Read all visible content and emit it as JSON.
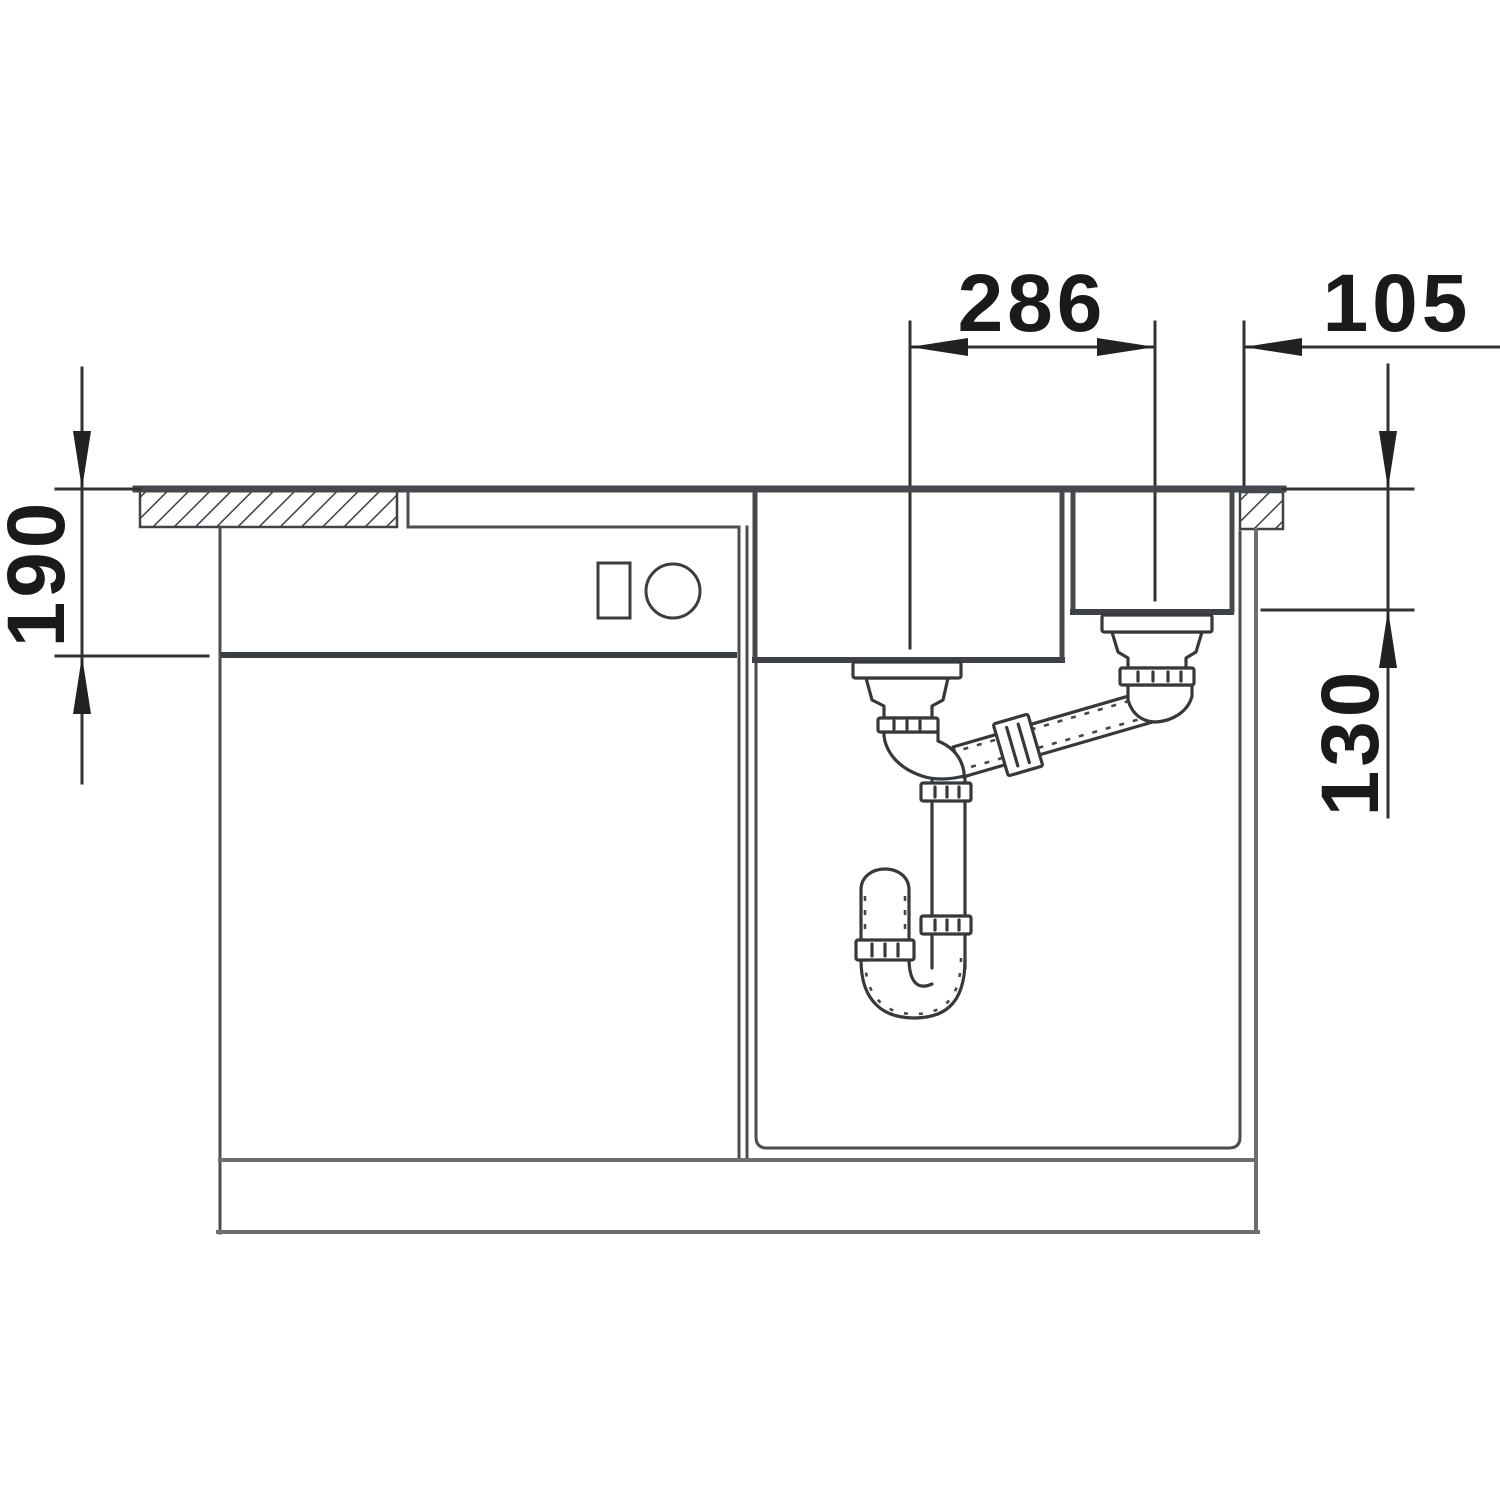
{
  "drawing": {
    "dimensions": [
      {
        "id": "dim-286",
        "label": "286",
        "orientation": "horizontal"
      },
      {
        "id": "dim-105",
        "label": "105",
        "orientation": "horizontal"
      },
      {
        "id": "dim-190",
        "label": "190",
        "orientation": "vertical"
      },
      {
        "id": "dim-130",
        "label": "130",
        "orientation": "vertical"
      }
    ],
    "colors": {
      "background": "#ffffff",
      "structure_line": "#45484c",
      "plumbing_line": "#36393c",
      "dimension_line": "#333333",
      "outer_wall_gray": "#6b6f73",
      "text": "#1a1a1a"
    }
  }
}
